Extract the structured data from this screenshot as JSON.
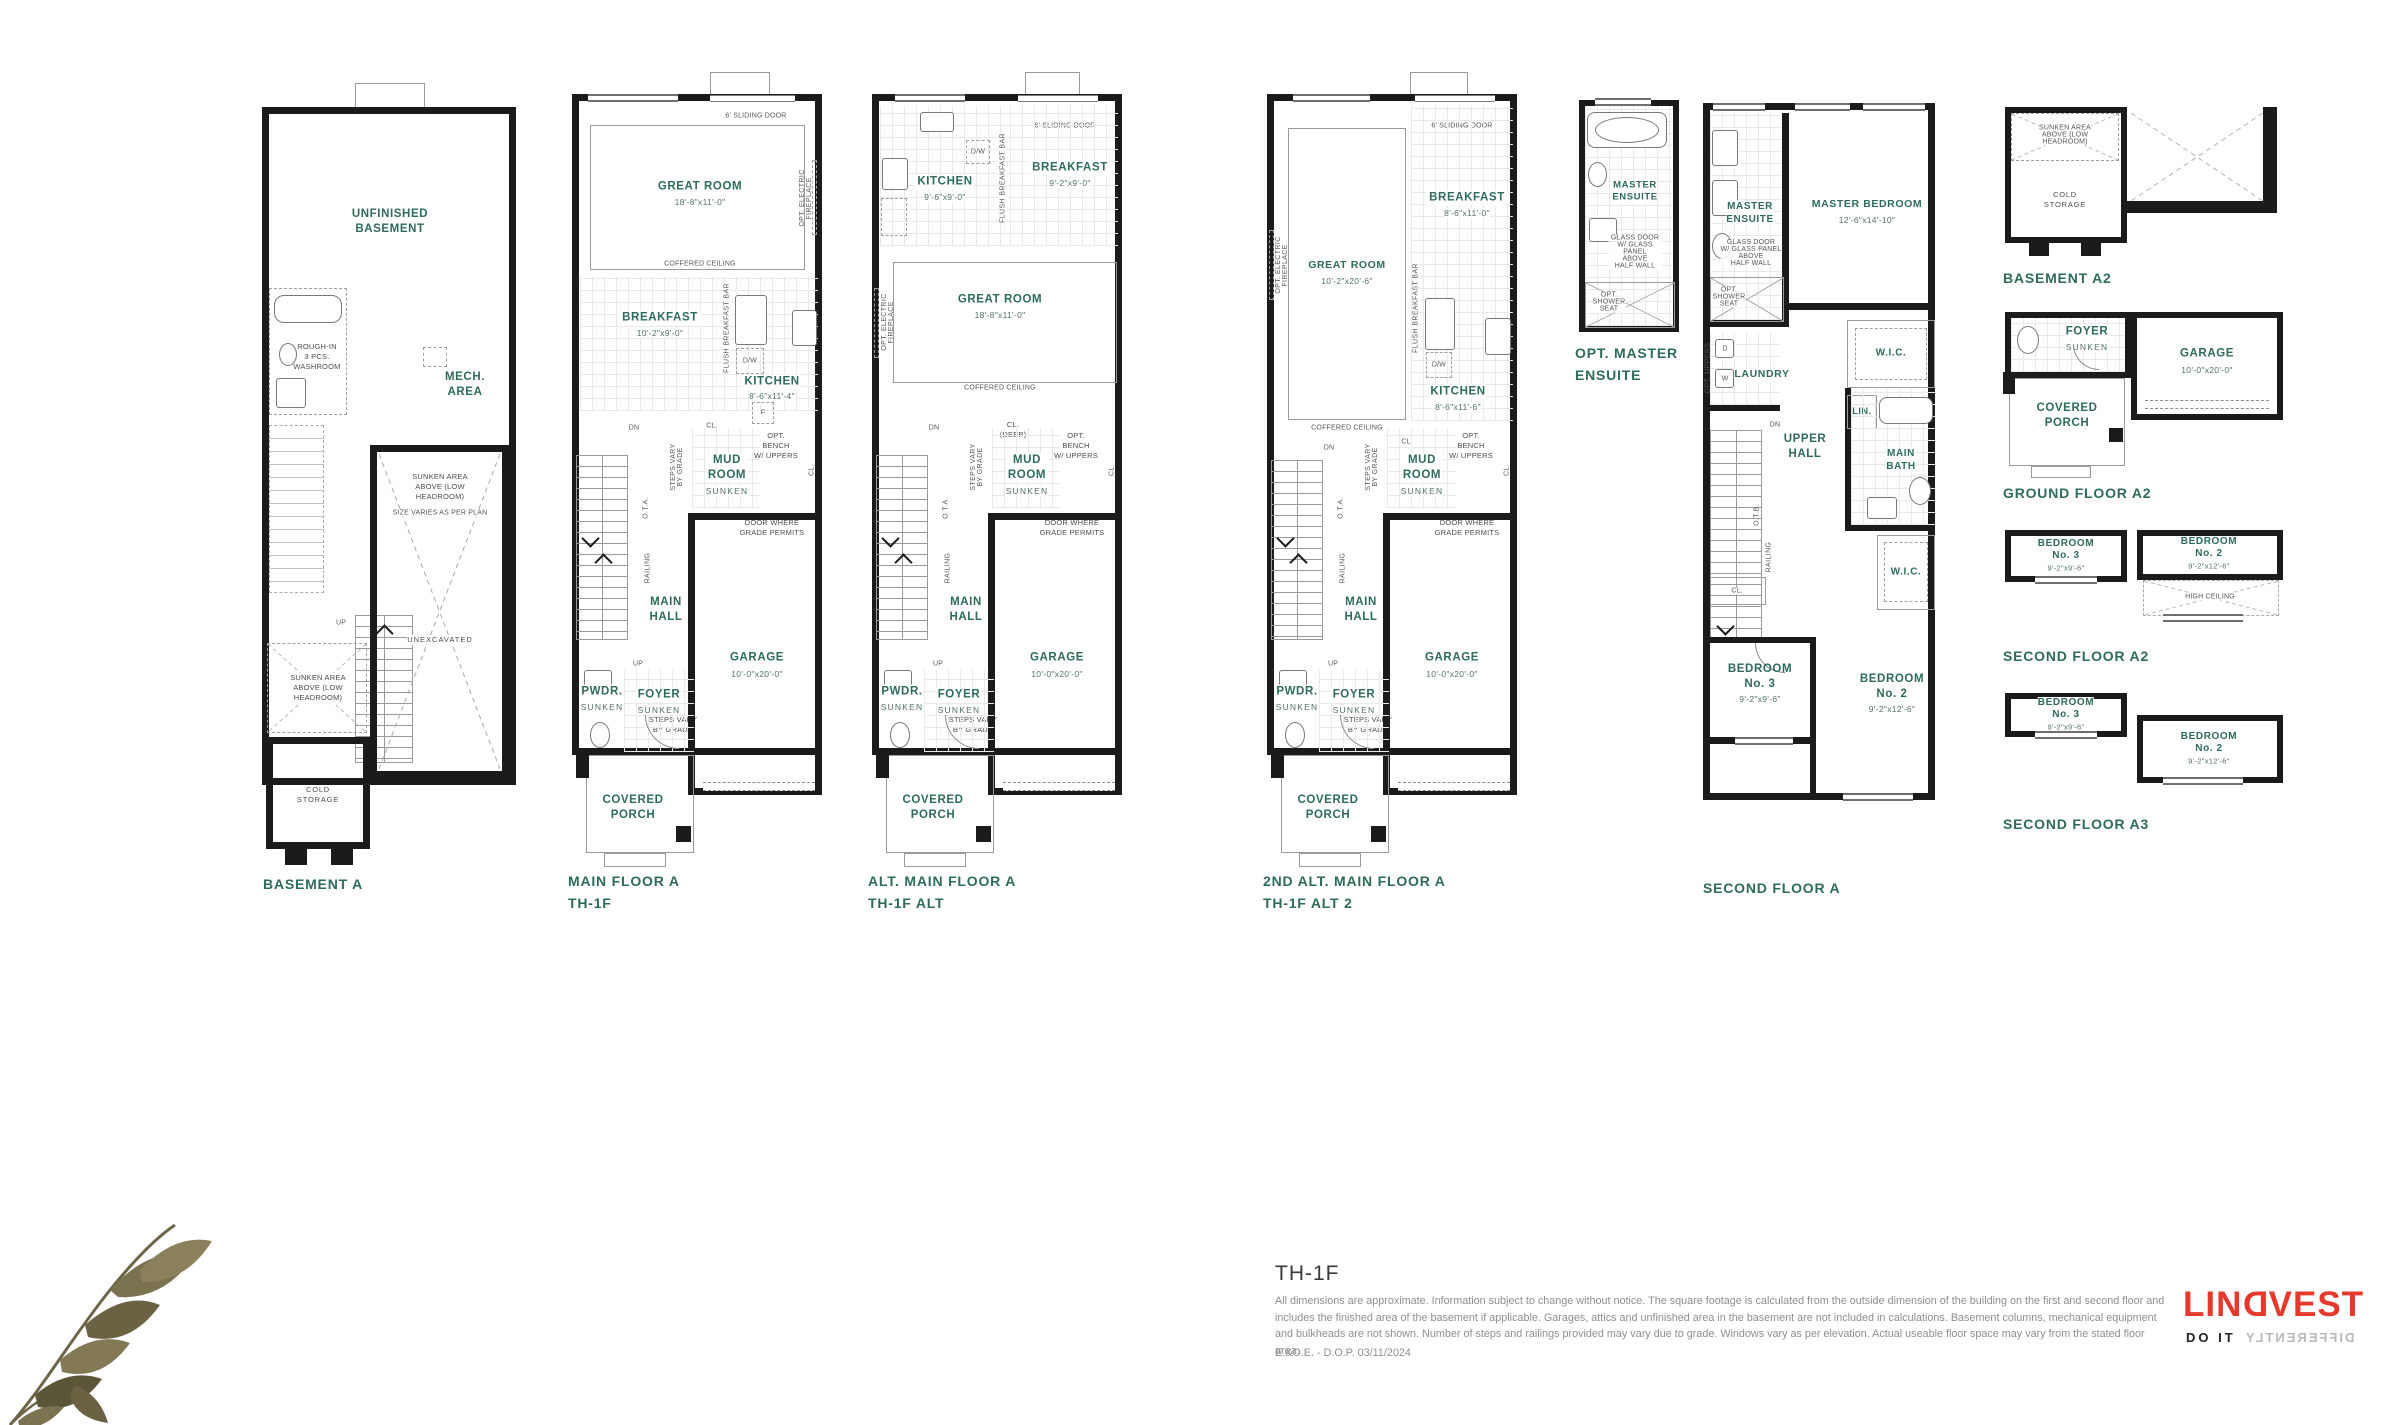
{
  "document": {
    "title": "TH-1F",
    "disclaimer": "All dimensions are approximate. Information subject to change without notice. The square footage is calculated from the outside dimension of the building on the first and second floor and includes the finished area of the basement if applicable. Garages, attics and unfinished area in the basement are not included in calculations. Basement columns, mechanical equipment and bulkheads are not shown. Number of steps and railings provided may vary due to grade. Windows vary as per elevation. Actual useable floor space may vary from the stated floor area.",
    "eoe": "E.&O.E. - D.O.P. 03/11/2024"
  },
  "logo": {
    "brand_prefix": "LIN",
    "brand_d": "D",
    "brand_suffix": "VEST",
    "tagline_left": "DO IT",
    "tagline_right": "DIFFERENTLY",
    "brand_color": "#e4392c"
  },
  "plans": {
    "basement_a": {
      "caption": "BASEMENT A",
      "unfinished": "UNFINISHED\nBASEMENT",
      "roughin": "ROUGH-IN\n3 PCS.\nWASHROOM",
      "mech": "MECH.\nAREA",
      "sunken_top": "SUNKEN AREA\nABOVE (LOW\nHEADROOM)",
      "size_varies": "SIZE VARIES AS PER PLAN",
      "unexcavated": "UNEXCAVATED",
      "up": "UP",
      "sunken_left": "SUNKEN AREA\nABOVE (LOW\nHEADROOM)",
      "cold": "COLD\nSTORAGE"
    },
    "main_a": {
      "caption": "MAIN FLOOR A\nTH-1F",
      "sliding": "6' SLIDING DOOR",
      "great": "GREAT ROOM",
      "great_dim": "18'-8\"x11'-0\"",
      "fireplace": "OPT. ELECTRIC\nFIREPLACE",
      "coffered": "COFFERED CEILING",
      "breakfast": "BREAKFAST",
      "breakfast_dim": "10'-2\"x9'-0\"",
      "flushbar": "FLUSH BREAKFAST BAR",
      "dw": "D/W",
      "kitchen": "KITCHEN",
      "kitchen_dim": "8'-6\"x11'-4\"",
      "fridge": "F",
      "dn": "DN",
      "cl": "CL.",
      "bench": "OPT.\nBENCH\nW/ UPPERS",
      "mud": "MUD\nROOM",
      "mud_sub": "SUNKEN",
      "cl2": "CL.",
      "door_grade": "DOOR WHERE\nGRADE PERMITS",
      "steps_v": "STEPS VARY\nBY GRADE",
      "ota": "O.T.A.",
      "railing": "RAILING",
      "hall": "MAIN\nHALL",
      "up": "UP",
      "steps": "STEPS VARY\nBY GRADE",
      "garage": "GARAGE",
      "garage_dim": "10'-0\"x20'-0\"",
      "pwdr": "PWDR.",
      "pwdr_sub": "SUNKEN",
      "foyer": "FOYER",
      "foyer_sub": "SUNKEN",
      "porch": "COVERED\nPORCH"
    },
    "alt_main_a": {
      "caption": "ALT. MAIN FLOOR A\nTH-1F ALT",
      "sliding": "6' SLIDING DOOR",
      "kitchen": "KITCHEN",
      "kitchen_dim": "9'-6\"x9'-0\"",
      "dw": "D/W",
      "flushbar": "FLUSH BREAKFAST BAR",
      "breakfast": "BREAKFAST",
      "breakfast_dim": "9'-2\"x9'-0\"",
      "fridge": "F",
      "great": "GREAT ROOM",
      "great_dim": "18'-8\"x11'-0\"",
      "fireplace": "OPT. ELECTRIC\nFIREPLACE",
      "coffered": "COFFERED CEILING",
      "dn": "DN",
      "cl": "CL.\n(DEEP)",
      "bench": "OPT.\nBENCH\nW/ UPPERS",
      "mud": "MUD\nROOM",
      "mud_sub": "SUNKEN",
      "cl2": "CL.",
      "door_grade": "DOOR WHERE\nGRADE PERMITS",
      "steps_v": "STEPS VARY\nBY GRADE",
      "ota": "O.T.A.",
      "railing": "RAILING",
      "hall": "MAIN\nHALL",
      "up": "UP",
      "steps": "STEPS VARY\nBY GRADE",
      "garage": "GARAGE",
      "garage_dim": "10'-0\"x20'-0\"",
      "pwdr": "PWDR.",
      "pwdr_sub": "SUNKEN",
      "foyer": "FOYER",
      "foyer_sub": "SUNKEN",
      "porch": "COVERED\nPORCH"
    },
    "alt2_main_a": {
      "caption": "2ND ALT. MAIN FLOOR A\nTH-1F ALT 2",
      "sliding": "6' SLIDING DOOR",
      "great": "GREAT ROOM",
      "great_dim": "10'-2\"x20'-6\"",
      "fireplace": "OPT. ELECTRIC\nFIREPLACE",
      "coffered": "COFFERED CEILING",
      "breakfast": "BREAKFAST",
      "breakfast_dim": "8'-6\"x11'-0\"",
      "flushbar": "FLUSH BREAKFAST BAR",
      "dw": "D/W",
      "kitchen": "KITCHEN",
      "kitchen_dim": "8'-6\"x11'-6\"",
      "dn": "DN",
      "cl": "CL.",
      "bench": "OPT.\nBENCH\nW/ UPPERS",
      "mud": "MUD\nROOM",
      "mud_sub": "SUNKEN",
      "cl2": "CL.",
      "door_grade": "DOOR WHERE\nGRADE PERMITS",
      "steps_v": "STEPS VARY\nBY GRADE",
      "ota": "O.T.A.",
      "railing": "RAILING",
      "hall": "MAIN\nHALL",
      "up": "UP",
      "steps": "STEPS VARY\nBY GRADE",
      "garage": "GARAGE",
      "garage_dim": "10'-0\"x20'-0\"",
      "pwdr": "PWDR.",
      "pwdr_sub": "SUNKEN",
      "foyer": "FOYER",
      "foyer_sub": "SUNKEN",
      "porch": "COVERED\nPORCH"
    },
    "opt_ensuite": {
      "caption": "OPT. MASTER\nENSUITE",
      "title": "MASTER\nENSUITE",
      "glass": "GLASS DOOR\nW/ GLASS PANEL\nABOVE\nHALF WALL",
      "shower": "OPT.\nSHOWER\nSEAT"
    },
    "second_a": {
      "caption": "SECOND FLOOR A",
      "ensuite": "MASTER\nENSUITE",
      "glass": "GLASS DOOR\nW/ GLASS PANEL\nABOVE\nHALF WALL",
      "shower": "OPT.\nSHOWER\nSEAT",
      "master": "MASTER BEDROOM",
      "master_dim": "12'-6\"x14'-10\"",
      "laundry": "LAUNDRY",
      "uppers": "OPT. UPPERS",
      "w": "W",
      "d": "D",
      "wic": "W.I.C.",
      "lin": "LIN.",
      "bath": "MAIN\nBATH",
      "hall": "UPPER\nHALL",
      "dn": "DN",
      "otb": "O.T.B.",
      "railing": "RAILING",
      "wic2": "W.I.C.",
      "cl": "CL.",
      "bed3": "BEDROOM\nNo. 3",
      "bed3_dim": "9'-2\"x9'-6\"",
      "bed2": "BEDROOM\nNo. 2",
      "bed2_dim": "9'-2\"x12'-6\""
    },
    "basement_a2": {
      "caption": "BASEMENT A2",
      "sunken": "SUNKEN AREA\nABOVE (LOW\nHEADROOM)",
      "cold": "COLD\nSTORAGE"
    },
    "ground_a2": {
      "caption": "GROUND FLOOR A2",
      "foyer": "FOYER",
      "foyer_sub": "SUNKEN",
      "garage": "GARAGE",
      "garage_dim": "10'-0\"x20'-0\"",
      "porch": "COVERED\nPORCH"
    },
    "second_a2": {
      "caption": "SECOND FLOOR A2",
      "bed3": "BEDROOM\nNo. 3",
      "bed3_dim": "9'-2\"x9'-6\"",
      "bed2": "BEDROOM\nNo. 2",
      "bed2_dim": "9'-2\"x12'-6\"",
      "high": "HIGH CEILING"
    },
    "second_a3": {
      "caption": "SECOND FLOOR A3",
      "bed3": "BEDROOM\nNo. 3",
      "bed3_dim": "9'-2\"x9'-6\"",
      "bed2": "BEDROOM\nNo. 2",
      "bed2_dim": "9'-2\"x12'-6\""
    }
  }
}
